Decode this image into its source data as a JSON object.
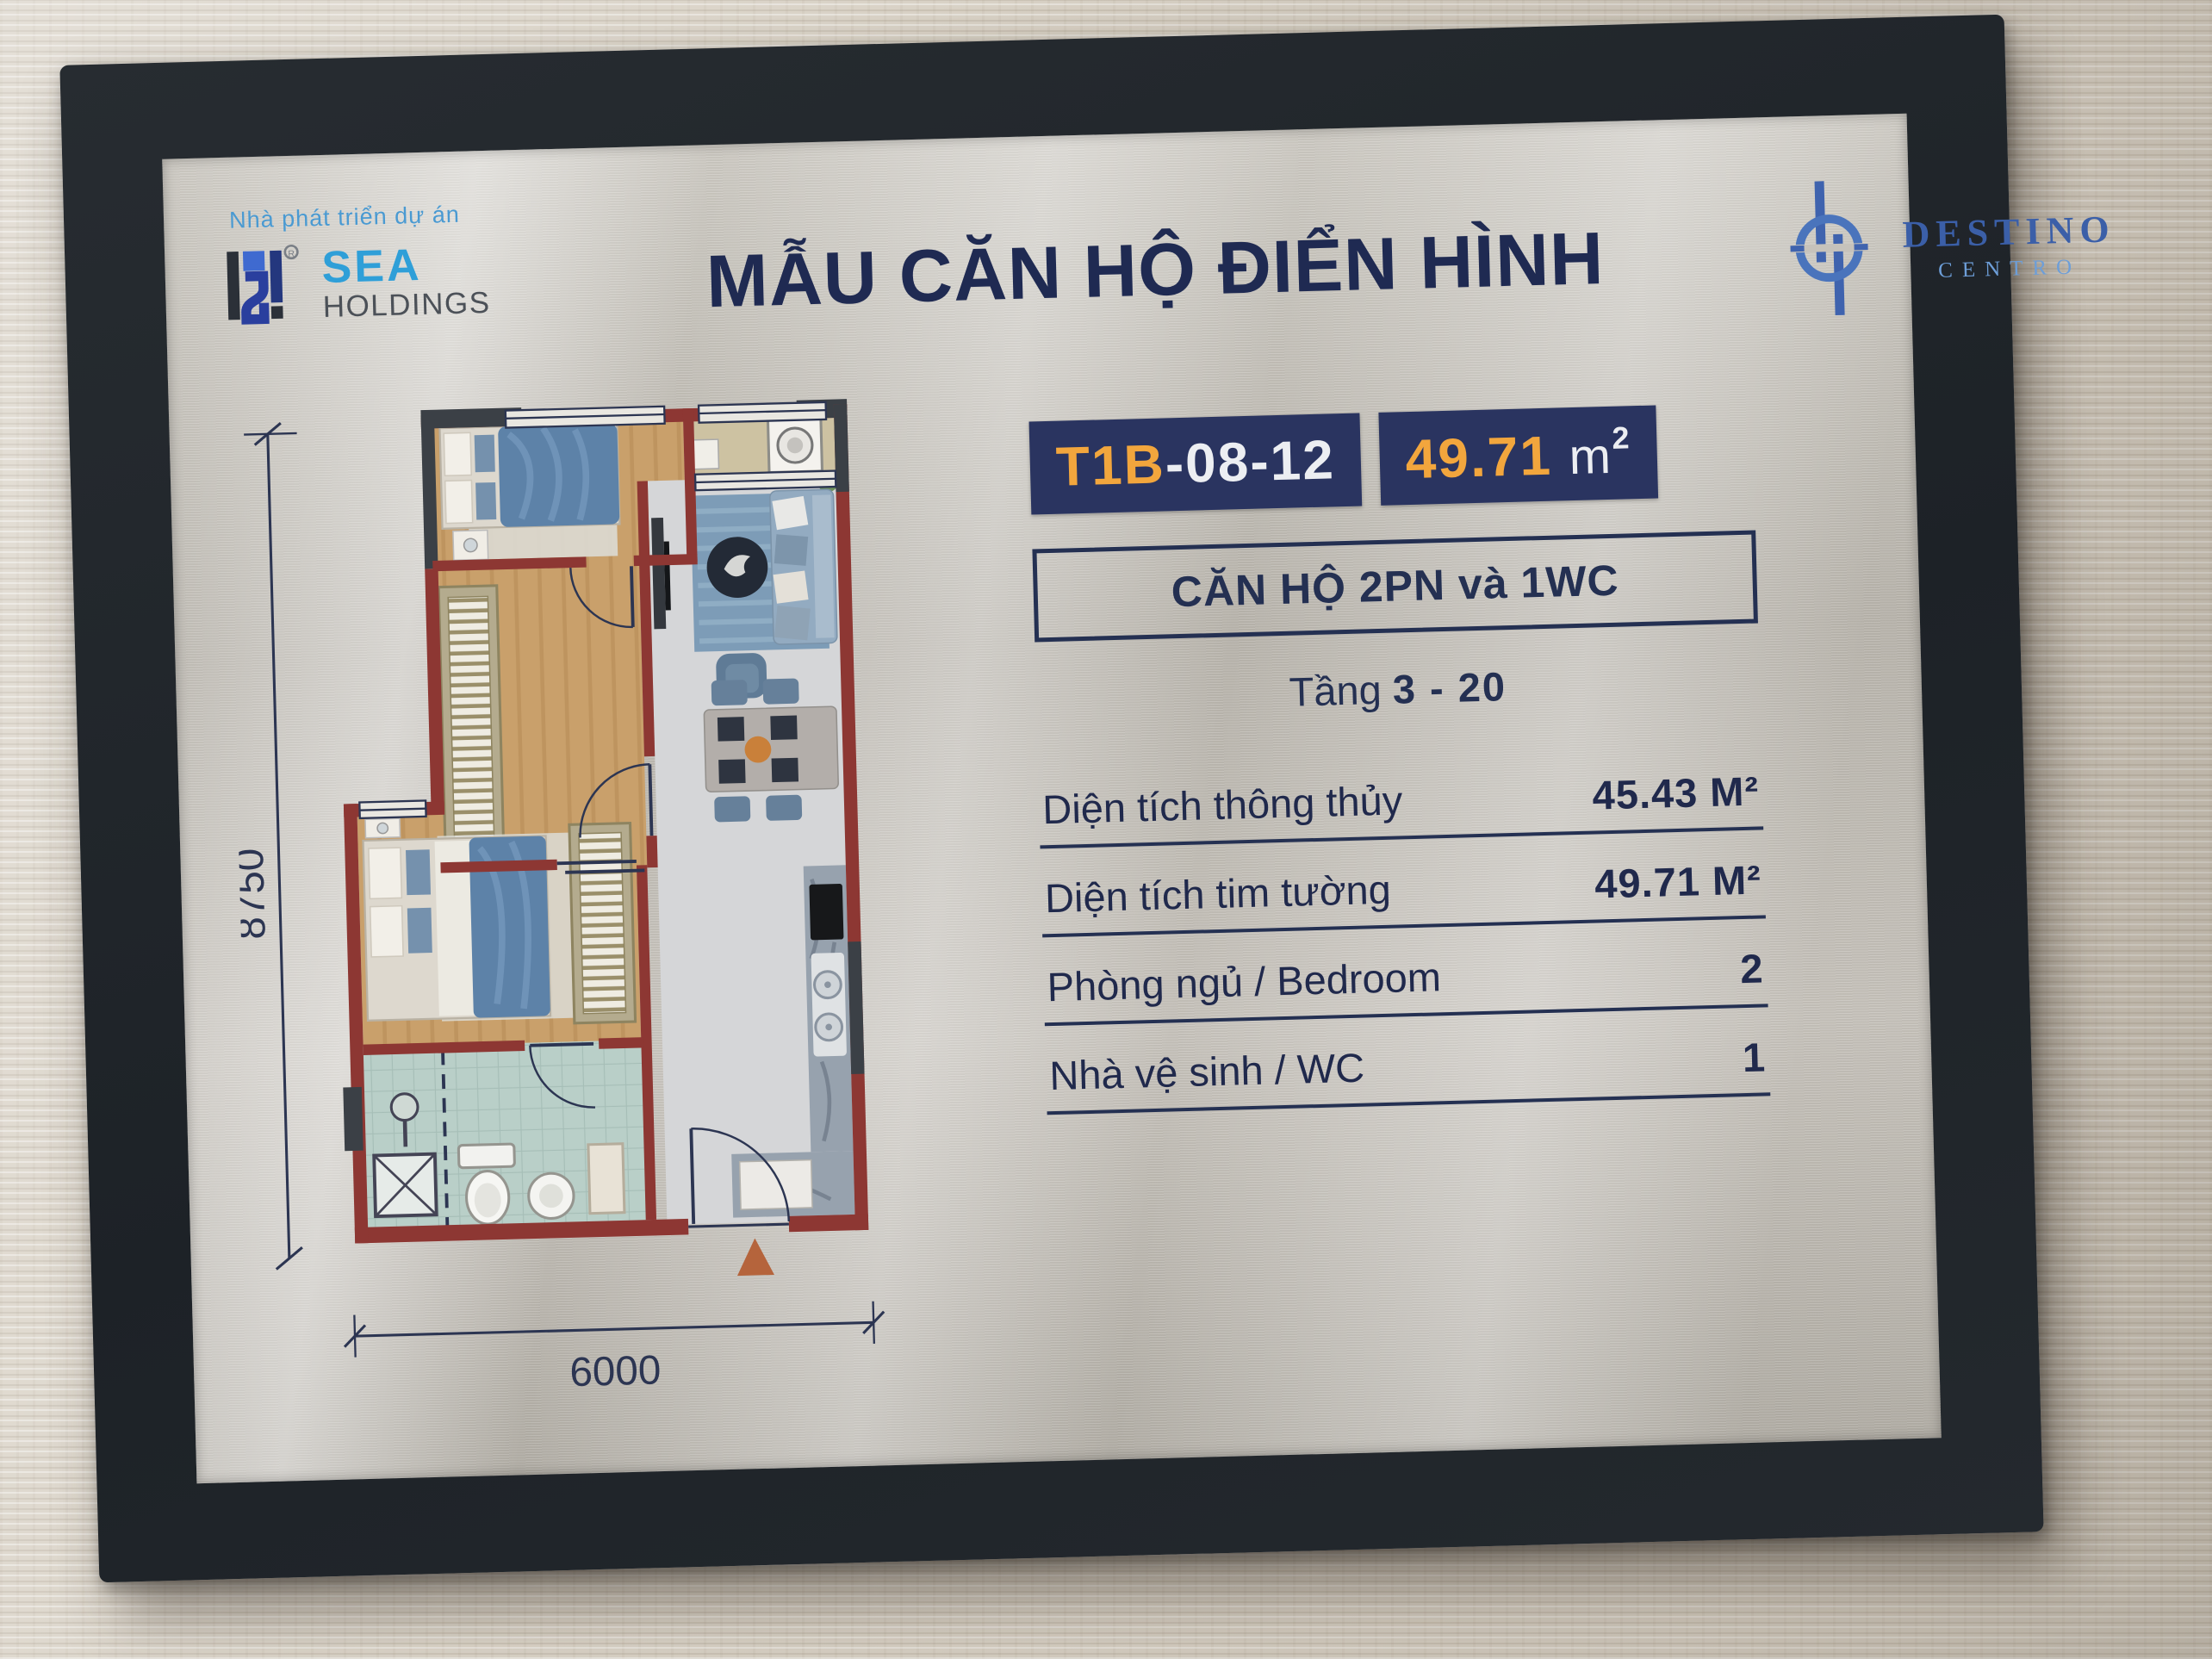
{
  "header": {
    "developer_tagline": "Nhà phát triển dự án",
    "developer_name_primary": "SEA",
    "developer_name_secondary": "HOLDINGS",
    "title": "MẪU CĂN HỘ ĐIỂN HÌNH",
    "project_name": "DESTINO",
    "project_subname": "CENTRO"
  },
  "unit": {
    "code_prefix": "T1B",
    "code_suffix": "-08-12",
    "area_value": "49.71",
    "area_unit_base": "m",
    "area_unit_exp": "2",
    "type_label": "CĂN HỘ 2PN và 1WC",
    "floor_label": "Tầng",
    "floor_range": "3 - 20"
  },
  "specs": [
    {
      "label": "Diện tích thông thủy",
      "value": "45.43 M²"
    },
    {
      "label": "Diện tích tim tường",
      "value": "49.71 M²"
    },
    {
      "label": "Phòng ngủ / Bedroom",
      "value": "2"
    },
    {
      "label": "Nhà vệ sinh / WC",
      "value": "1"
    }
  ],
  "floorplan": {
    "height_dim": "8750",
    "width_dim": "6000"
  },
  "colors": {
    "navy_text": "#1f2a52",
    "badge_bg": "#2a3460",
    "accent_orange": "#f2a63d",
    "sea_blue": "#2f9fd8",
    "destino_blue": "#3b5fa8",
    "wall_red": "#8d3733",
    "wall_dark": "#3b4046",
    "frame_black": "#22272c"
  }
}
